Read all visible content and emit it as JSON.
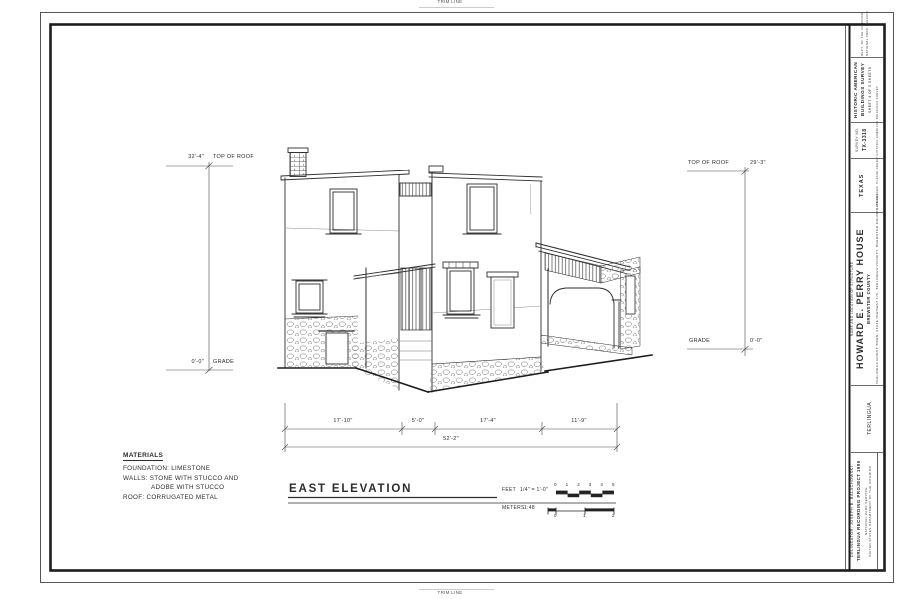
{
  "sheet": {
    "trim_top": "TRIM LINE",
    "trim_bottom": "TRIM LINE"
  },
  "title_block": {
    "agency_line1": "DEPT. OF THE INTERIOR",
    "agency_line2": "NATIONAL PARK SERVICE",
    "survey_title_line1": "HISTORIC AMERICAN",
    "survey_title_line2": "BUILDINGS SURVEY",
    "sheet_info": "SHEET 4 OF 5 SHEETS",
    "survey_no_label": "SURVEY NO.",
    "survey_no": "TX-3318",
    "state": "TEXAS",
    "reproduction_note": "IF REPRODUCED, PLEASE CREDIT HISTORIC AMERICAN BUILDINGS SURVEY",
    "structure_label": "NAME AND LOCATION OF STRUCTURE",
    "structure_name": "HOWARD E. PERRY HOUSE",
    "structure_county": "BREWSTER COUNTY",
    "structure_address": "TERLINGUA GHOST TOWN, STATE HIGHWAY 170, TERLINGUA VICINITY, BREWSTER COUNTY, TEXAS",
    "town": "TERLINGUA",
    "credits": [
      "DELINEATOR: JOSEPH B. BALACHOWSKI",
      "TERLINGUA RECORDING PROJECT 1995",
      "NATIONAL PARK SERVICE",
      "UNITED STATES DEPARTMENT OF THE INTERIOR"
    ]
  },
  "elevation": {
    "title": "EAST ELEVATION",
    "left_top_value": "32'-4\"",
    "left_top_label": "TOP OF ROOF",
    "left_bottom_value": "0'-0\"",
    "left_bottom_label": "GRADE",
    "right_top_label": "TOP OF ROOF",
    "right_top_value": "29'-3\"",
    "right_bottom_label": "GRADE",
    "right_bottom_value": "0'-0\"",
    "dims": [
      "17'-10\"",
      "5'-0\"",
      "17'-4\"",
      "11'-9\""
    ],
    "total": "52'-2\""
  },
  "materials": {
    "heading": "MATERIALS",
    "lines": [
      "FOUNDATION: LIMESTONE",
      "WALLS: STONE WITH STUCCO AND",
      "ADOBE WITH STUCCO",
      "ROOF: CORRUGATED METAL"
    ]
  },
  "scale": {
    "feet_label": "FEET",
    "feet_value": "1/4\" = 1'-0\"",
    "feet_ticks": [
      "0",
      "1",
      "2",
      "3",
      "4",
      "5"
    ],
    "meters_label": "METERS",
    "meters_value": "1:48",
    "meters_ticks": [
      "0",
      "1",
      "2"
    ]
  }
}
